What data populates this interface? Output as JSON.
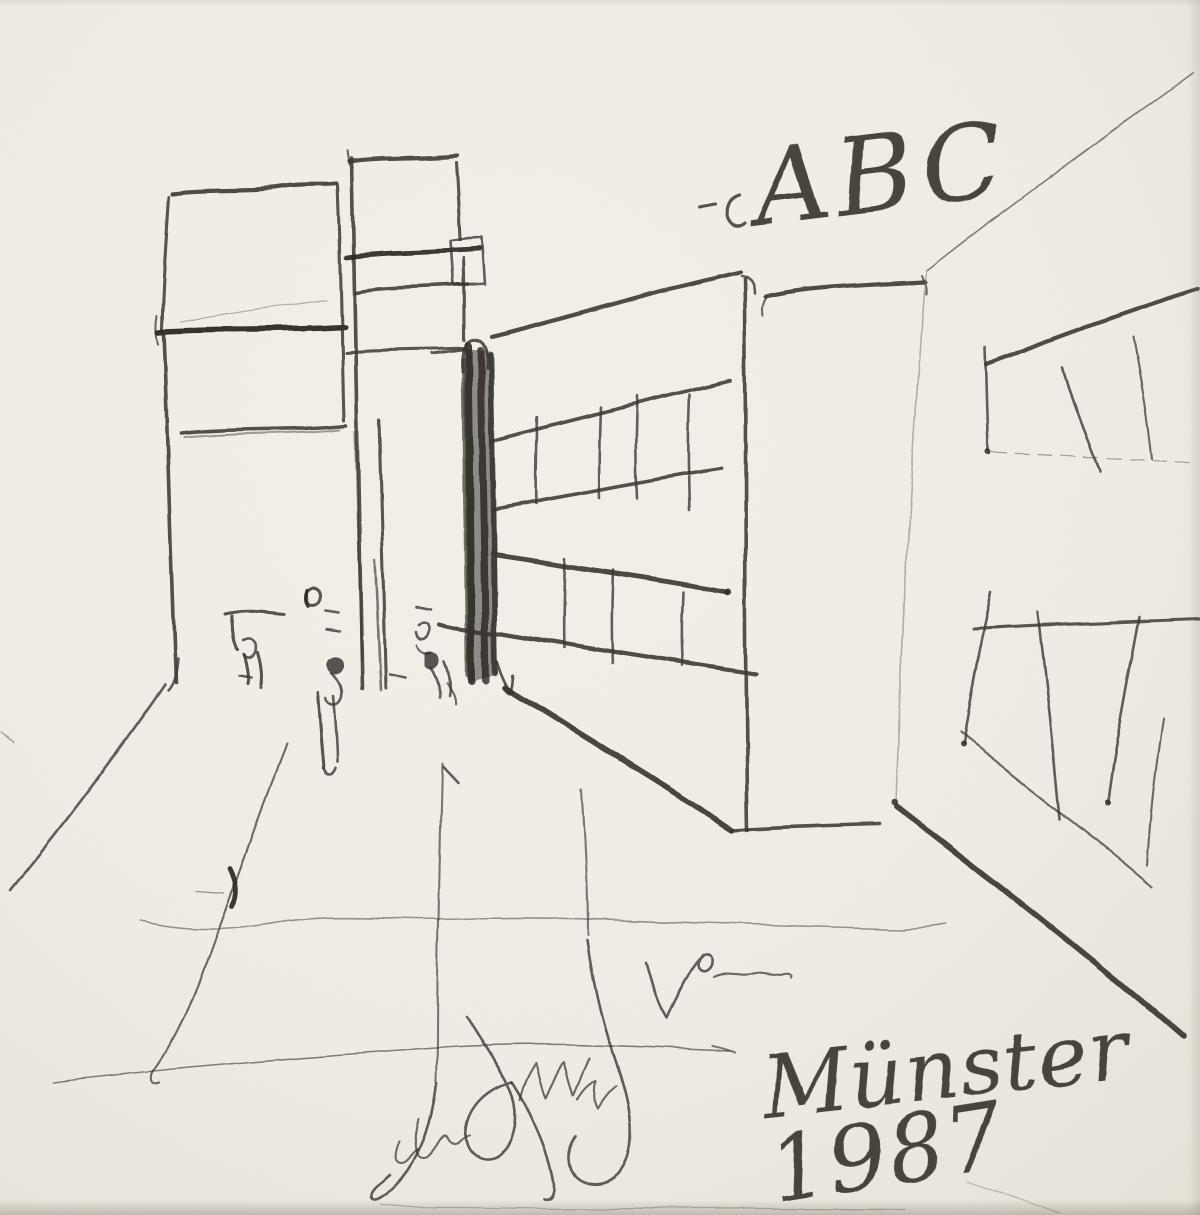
{
  "inscriptions": {
    "top_right": "ABC",
    "place": "Münster",
    "year": "1987"
  },
  "palette": {
    "paper": "#f2efe8",
    "paper_mid": "#edeae2",
    "paper_edge_shadow": "#d9d4ca",
    "pencil_dark": "#2e2c29",
    "pencil_mid": "#57534d",
    "pencil_faint": "#a39d93"
  },
  "scene": {
    "elements": [
      "left-building",
      "center-tower",
      "dark-entrance-column",
      "center-building",
      "right-building",
      "street-perspective-lines",
      "pedestrian-figures",
      "foreground-vertical-lines",
      "signature-scrawl"
    ]
  }
}
